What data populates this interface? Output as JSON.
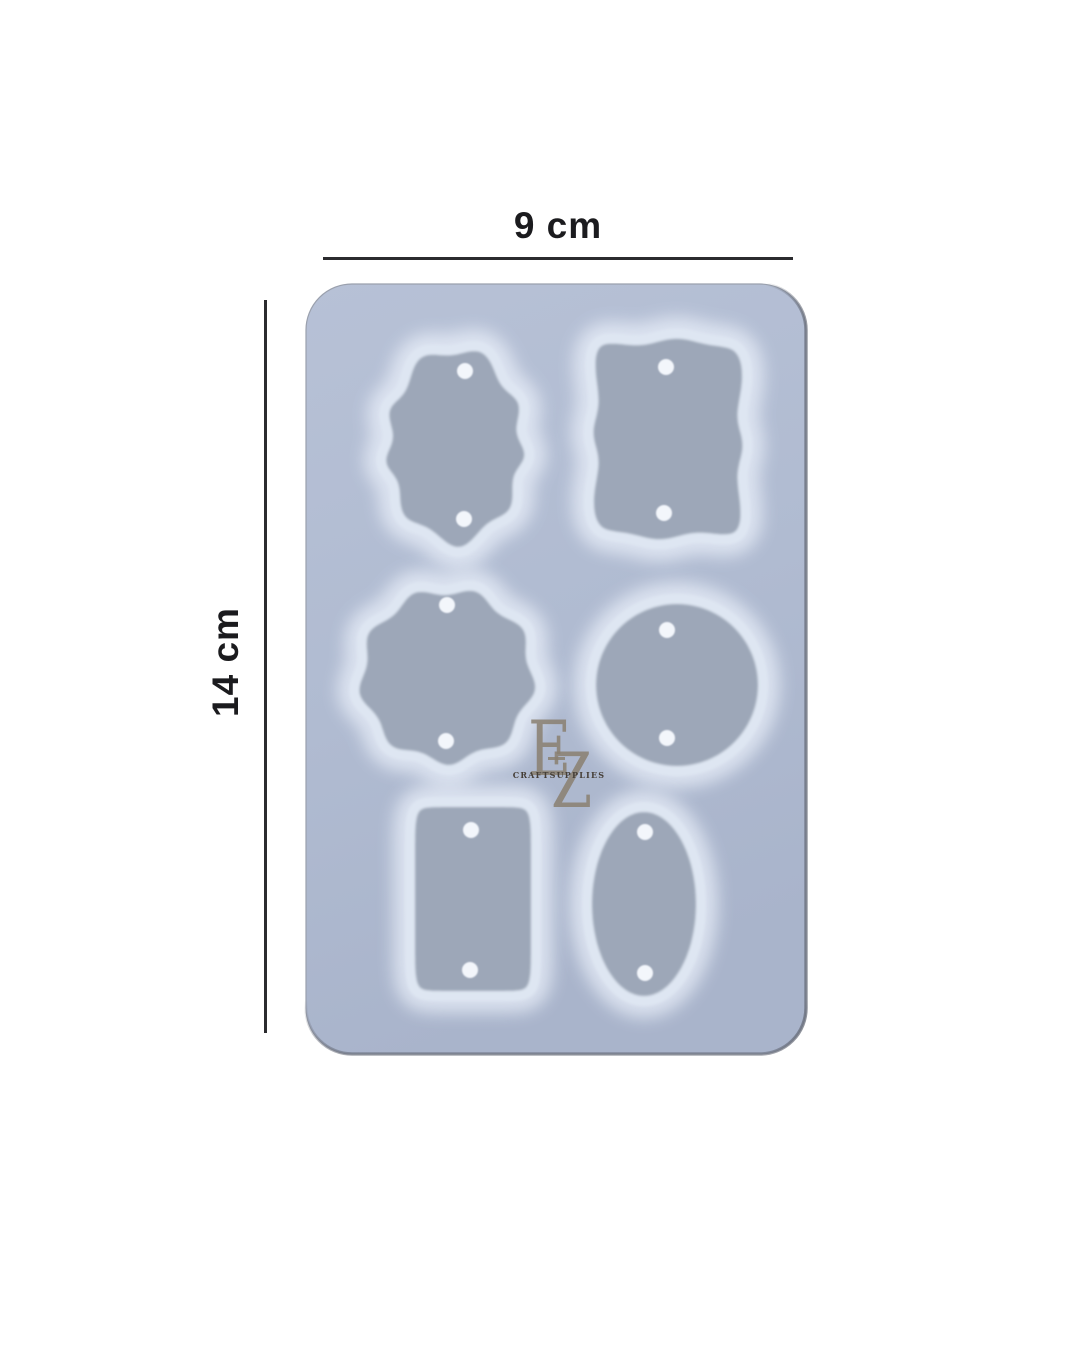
{
  "image": {
    "type": "product-photo",
    "subject": "Translucent silicone resin mold with six pendant/tag cavities and dimension annotations",
    "background_color": "#ffffff"
  },
  "dimensions": {
    "width_label": "9 cm",
    "height_label": "14 cm",
    "line_color": "#2b2b2e",
    "label_color": "#1b1b1e"
  },
  "watermark": {
    "letter_1": "E",
    "letter_2": "Z",
    "subtitle": "CRAFTSUPPLIES",
    "letter_color": "#8a8071",
    "subtitle_color": "#453e37"
  },
  "mold": {
    "surface_color_light": "#b7c1d6",
    "surface_color_dark": "#a9b4cb",
    "cavity_color": "#9da7b8",
    "ridge_color": "#dee6f2",
    "halo_color": "#e9eff9",
    "hole_color": "#f3f6fb",
    "edge_color": "#9aa0ad",
    "cavities": [
      {
        "name": "wavy-oval-tag-cavity",
        "holes": 2
      },
      {
        "name": "wavy-rectangle-tag-cavity",
        "holes": 2
      },
      {
        "name": "wavy-circle-tag-cavity",
        "holes": 2
      },
      {
        "name": "circle-tag-cavity",
        "holes": 2
      },
      {
        "name": "rectangle-tag-cavity",
        "holes": 2
      },
      {
        "name": "oval-tag-cavity",
        "holes": 2
      }
    ]
  }
}
